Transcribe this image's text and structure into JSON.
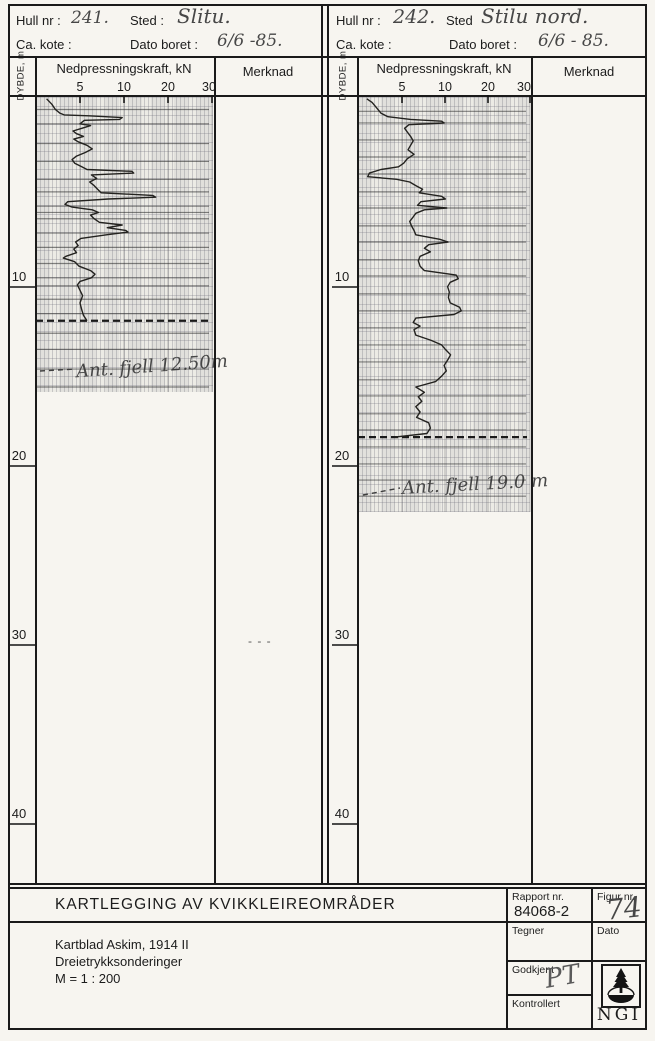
{
  "page": {
    "background": "#f7f5f0",
    "ink": "#1c1c1c",
    "pencil": "#474747"
  },
  "boreholes": [
    {
      "header": {
        "hull_label": "Hull nr :",
        "hull_value": "241.",
        "sted_label": "Sted :",
        "sted_value": "Slitu.",
        "kote_label": "Ca. kote :",
        "dato_label": "Dato boret :",
        "dato_value": "6/6 -85."
      },
      "axis": {
        "depth_unit_label": "DYBDE, m",
        "force_label": "Nedpressningskraft, kN",
        "merknad_label": "Merknad",
        "force_ticks": [
          "5",
          "10",
          "20",
          "30"
        ],
        "depth_ticks": [
          "10",
          "20",
          "30",
          "40"
        ]
      },
      "annotation": "Ant. fjell 12.50m",
      "merknad_note": "- - -"
    },
    {
      "header": {
        "hull_label": "Hull nr :",
        "hull_value": "242.",
        "sted_label": "Sted",
        "sted_value": "Stilu nord.",
        "kote_label": "Ca. kote :",
        "dato_label": "Dato boret :",
        "dato_value": "6/6 - 85."
      },
      "axis": {
        "depth_unit_label": "DYBDE, m",
        "force_label": "Nedpressningskraft, kN",
        "merknad_label": "Merknad",
        "force_ticks": [
          "5",
          "10",
          "20",
          "30"
        ],
        "depth_ticks": [
          "10",
          "20",
          "30",
          "40"
        ]
      },
      "annotation": "Ant. fjell 19.0 m",
      "merknad_note": ""
    }
  ],
  "title_block": {
    "title": "KARTLEGGING AV KVIKKLEIREOMRÅDER",
    "lines": [
      "Kartblad Askim, 1914 II",
      "Dreietrykksonderinger",
      "M = 1 : 200"
    ],
    "rapport_label": "Rapport nr.",
    "rapport_value": "84068-2",
    "figur_label": "Figur nr.",
    "figur_value": "74",
    "tegner_label": "Tegner",
    "dato_label": "Dato",
    "godkjent_label": "Godkjent",
    "godkjent_value": "PT",
    "kontrollert_label": "Kontrollert",
    "logo_text": "NGI"
  },
  "chart_data": [
    {
      "type": "line",
      "title": "Hull 241 - Slitu",
      "xlabel": "Nedpressningskraft, kN",
      "ylabel": "DYBDE, m",
      "x_ticks": [
        5,
        10,
        20,
        30
      ],
      "x_scale_note": "segmented axis: equal pixel spacing between 0-5, 5-10, 10-20, 20-30 kN",
      "ylim": [
        0,
        44
      ],
      "rock_depth_m": 12.5,
      "layer_lines_m": [
        0.7,
        1.5,
        2.6,
        3.6,
        4.6,
        5.3,
        6.1,
        6.45,
        6.8,
        7.6,
        8.4,
        9.3,
        10.1,
        10.55,
        11.3,
        12.1,
        13.2,
        14.1,
        15.2,
        16.2
      ],
      "series": [
        {
          "name": "Nedpressningskraft",
          "points": [
            [
              0.1,
              1.2
            ],
            [
              0.4,
              1.8
            ],
            [
              0.7,
              2.2
            ],
            [
              0.9,
              2.7
            ],
            [
              1.0,
              3.2
            ],
            [
              1.05,
              6.0
            ],
            [
              1.15,
              9.8
            ],
            [
              1.25,
              9.5
            ],
            [
              1.3,
              5.5
            ],
            [
              1.5,
              5.0
            ],
            [
              1.6,
              6.2
            ],
            [
              1.75,
              5.2
            ],
            [
              1.9,
              4.2
            ],
            [
              2.05,
              4.6
            ],
            [
              2.2,
              5.4
            ],
            [
              2.35,
              4.3
            ],
            [
              2.5,
              4.8
            ],
            [
              2.7,
              5.8
            ],
            [
              2.9,
              6.4
            ],
            [
              3.1,
              5.6
            ],
            [
              3.3,
              4.6
            ],
            [
              3.5,
              4.1
            ],
            [
              3.7,
              4.4
            ],
            [
              3.9,
              5.2
            ],
            [
              4.05,
              5.8
            ],
            [
              4.15,
              11.8
            ],
            [
              4.25,
              12.2
            ],
            [
              4.35,
              6.3
            ],
            [
              4.55,
              6.9
            ],
            [
              4.75,
              6.1
            ],
            [
              4.95,
              6.6
            ],
            [
              5.15,
              7.0
            ],
            [
              5.35,
              7.4
            ],
            [
              5.5,
              16.5
            ],
            [
              5.6,
              17.2
            ],
            [
              5.7,
              8.2
            ],
            [
              5.85,
              3.6
            ],
            [
              6.0,
              3.3
            ],
            [
              6.15,
              4.1
            ],
            [
              6.3,
              6.4
            ],
            [
              6.45,
              7.1
            ],
            [
              6.6,
              6.2
            ],
            [
              6.8,
              6.6
            ],
            [
              7.0,
              7.2
            ],
            [
              7.15,
              9.8
            ],
            [
              7.3,
              8.1
            ],
            [
              7.45,
              10.4
            ],
            [
              7.55,
              10.9
            ],
            [
              7.7,
              8.0
            ],
            [
              7.9,
              5.1
            ],
            [
              8.1,
              4.5
            ],
            [
              8.3,
              4.8
            ],
            [
              8.5,
              4.3
            ],
            [
              8.7,
              4.6
            ],
            [
              8.9,
              3.4
            ],
            [
              9.0,
              3.1
            ],
            [
              9.2,
              4.4
            ],
            [
              9.45,
              4.9
            ],
            [
              9.7,
              6.2
            ],
            [
              9.9,
              6.7
            ],
            [
              10.1,
              6.3
            ],
            [
              10.3,
              5.0
            ],
            [
              10.5,
              4.7
            ],
            [
              10.8,
              5.0
            ],
            [
              11.1,
              5.3
            ],
            [
              11.5,
              5.0
            ],
            [
              11.9,
              5.2
            ],
            [
              12.2,
              5.4
            ],
            [
              12.5,
              5.8
            ]
          ]
        }
      ]
    },
    {
      "type": "line",
      "title": "Hull 242 - Stilu nord",
      "xlabel": "Nedpressningskraft, kN",
      "ylabel": "DYBDE, m",
      "x_ticks": [
        5,
        10,
        20,
        30
      ],
      "x_scale_note": "segmented axis: equal pixel spacing between 0-5, 5-10, 10-20, 20-30 kN",
      "ylim": [
        0,
        44
      ],
      "rock_depth_m": 19.0,
      "layer_lines_m": [
        0.8,
        1.45,
        2.4,
        3.35,
        4.3,
        5.3,
        6.2,
        7.2,
        8.1,
        9.1,
        10.0,
        11.0,
        11.95,
        12.9,
        13.85,
        14.8,
        15.8,
        16.7,
        17.7,
        18.6,
        19.55,
        20.5,
        21.4,
        22.3
      ],
      "series": [
        {
          "name": "Nedpressningskraft",
          "points": [
            [
              0.1,
              1.0
            ],
            [
              0.3,
              1.6
            ],
            [
              0.6,
              2.1
            ],
            [
              0.9,
              2.6
            ],
            [
              1.1,
              3.4
            ],
            [
              1.25,
              6.0
            ],
            [
              1.35,
              9.6
            ],
            [
              1.45,
              9.9
            ],
            [
              1.55,
              5.8
            ],
            [
              1.75,
              5.3
            ],
            [
              1.95,
              5.6
            ],
            [
              2.2,
              6.0
            ],
            [
              2.45,
              6.3
            ],
            [
              2.7,
              6.0
            ],
            [
              2.95,
              5.7
            ],
            [
              3.2,
              6.4
            ],
            [
              3.45,
              5.6
            ],
            [
              3.7,
              5.2
            ],
            [
              3.9,
              4.6
            ],
            [
              4.05,
              2.6
            ],
            [
              4.25,
              1.3
            ],
            [
              4.45,
              1.1
            ],
            [
              4.6,
              4.4
            ],
            [
              4.75,
              5.9
            ],
            [
              4.95,
              6.6
            ],
            [
              5.15,
              7.4
            ],
            [
              5.35,
              7.0
            ],
            [
              5.55,
              9.6
            ],
            [
              5.7,
              10.1
            ],
            [
              5.85,
              7.2
            ],
            [
              6.05,
              6.8
            ],
            [
              6.2,
              10.4
            ],
            [
              6.3,
              7.6
            ],
            [
              6.5,
              6.6
            ],
            [
              6.7,
              6.3
            ],
            [
              6.95,
              5.9
            ],
            [
              7.2,
              6.1
            ],
            [
              7.45,
              6.4
            ],
            [
              7.7,
              6.6
            ],
            [
              7.95,
              9.4
            ],
            [
              8.1,
              10.7
            ],
            [
              8.25,
              8.1
            ],
            [
              8.45,
              7.6
            ],
            [
              8.65,
              8.3
            ],
            [
              8.9,
              7.1
            ],
            [
              9.15,
              6.9
            ],
            [
              9.45,
              7.1
            ],
            [
              9.7,
              7.6
            ],
            [
              9.95,
              12.6
            ],
            [
              10.15,
              13.1
            ],
            [
              10.35,
              11.2
            ],
            [
              10.6,
              10.6
            ],
            [
              10.9,
              11.0
            ],
            [
              11.2,
              10.8
            ],
            [
              11.5,
              11.2
            ],
            [
              11.75,
              13.4
            ],
            [
              11.95,
              13.8
            ],
            [
              12.15,
              12.1
            ],
            [
              12.35,
              6.6
            ],
            [
              12.6,
              6.3
            ],
            [
              12.8,
              7.1
            ],
            [
              13.0,
              6.4
            ],
            [
              13.3,
              6.6
            ],
            [
              13.6,
              8.4
            ],
            [
              13.85,
              9.6
            ],
            [
              14.1,
              10.1
            ],
            [
              14.4,
              11.3
            ],
            [
              14.7,
              10.6
            ],
            [
              15.0,
              9.9
            ],
            [
              15.3,
              10.3
            ],
            [
              15.6,
              9.6
            ],
            [
              15.9,
              8.9
            ],
            [
              16.2,
              6.6
            ],
            [
              16.5,
              7.6
            ],
            [
              16.75,
              6.9
            ],
            [
              17.0,
              7.3
            ],
            [
              17.3,
              6.6
            ],
            [
              17.6,
              7.1
            ],
            [
              17.9,
              6.7
            ],
            [
              18.2,
              8.1
            ],
            [
              18.5,
              8.3
            ],
            [
              18.8,
              7.9
            ],
            [
              19.0,
              4.2
            ]
          ]
        }
      ]
    }
  ]
}
